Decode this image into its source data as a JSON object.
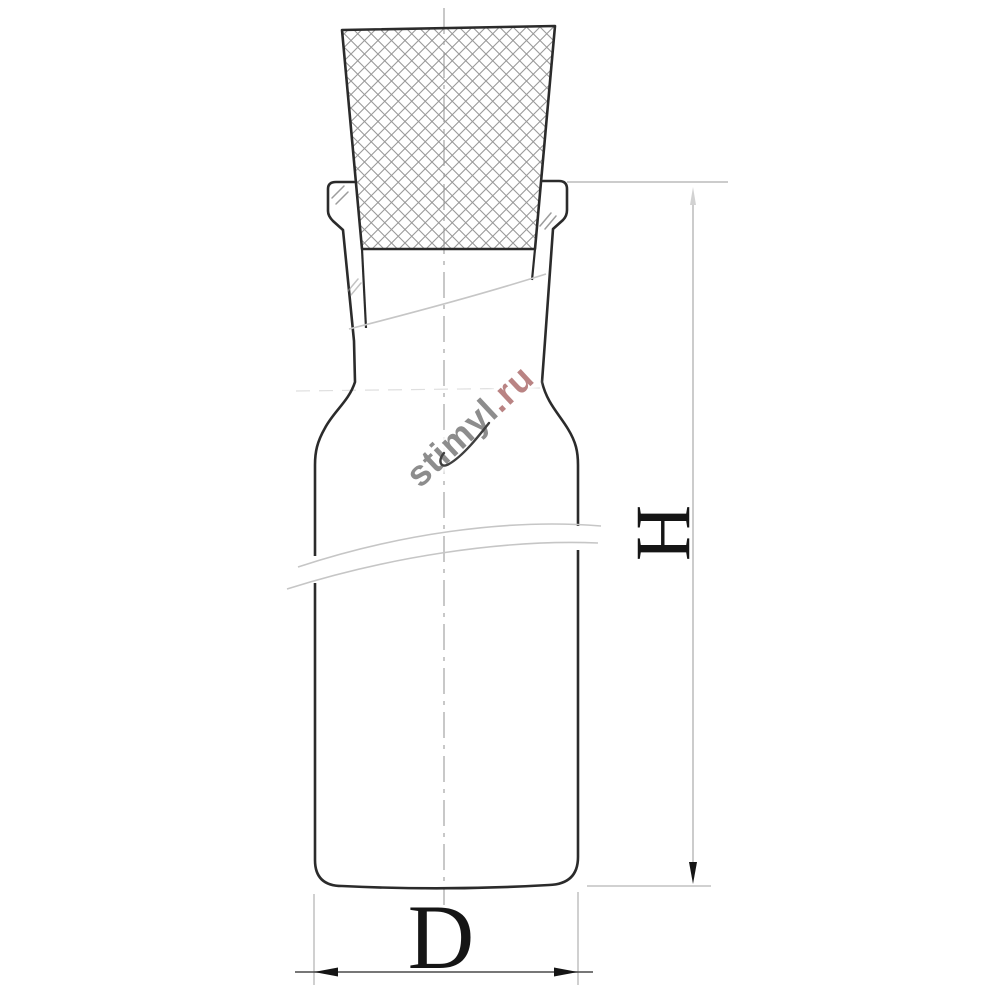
{
  "drawing": {
    "type": "technical-line-drawing",
    "subject": "laboratory-square-bottle-with-ground-glass-stopper",
    "labels": {
      "height": "H",
      "diameter": "D"
    },
    "watermark": {
      "name": "stimyl",
      "tld": ".ru"
    },
    "colors": {
      "background": "#ffffff",
      "outline": "#2b2b2b",
      "hatch": "#9a9a9a",
      "centerline": "#ababab",
      "extension": "#bcbcbc",
      "break_line": "#c6c6c6",
      "dimension_line": "#4a4a4a",
      "ink": "#151515",
      "faint_arrow": "#d2d2d2",
      "tick": "#9c9c9c",
      "watermark_gray": "#8d8d8d",
      "watermark_red": "#b98383",
      "watermark_flourish": "#3f3f3f"
    }
  }
}
